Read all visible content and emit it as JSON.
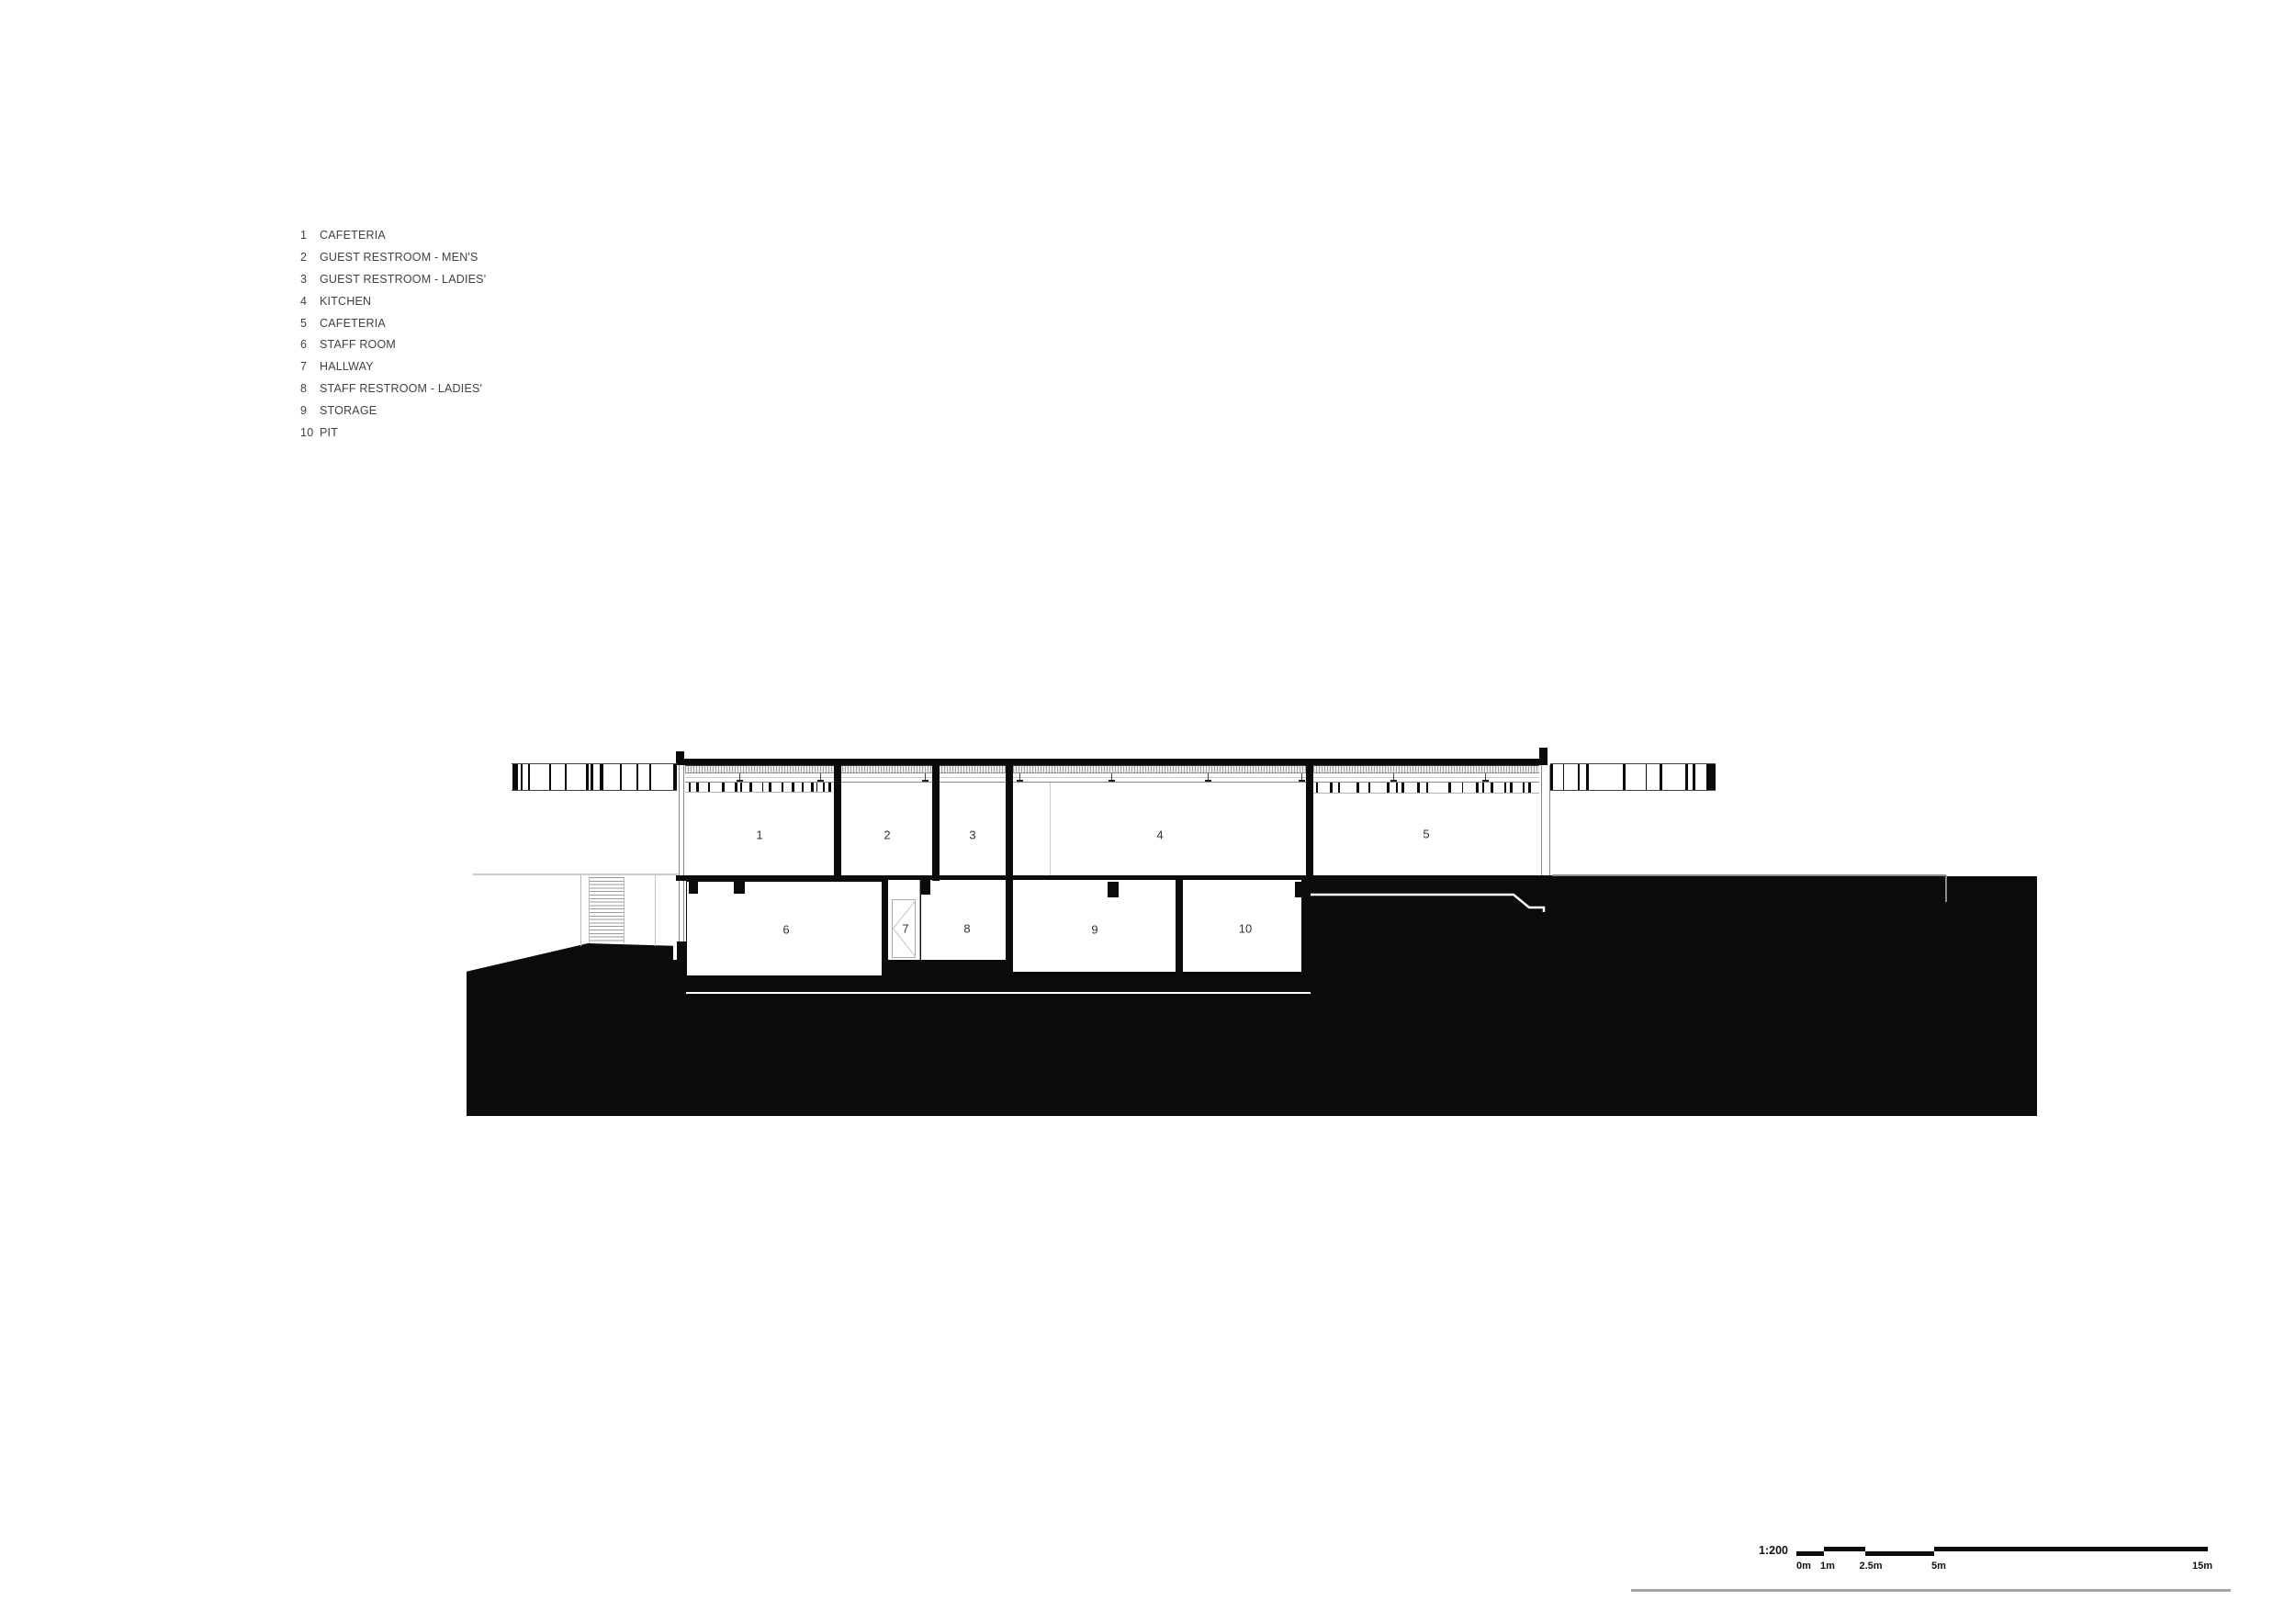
{
  "legend": {
    "items": [
      {
        "num": "1",
        "label": "CAFETERIA"
      },
      {
        "num": "2",
        "label": "GUEST RESTROOM - MEN'S"
      },
      {
        "num": "3",
        "label": "GUEST RESTROOM - LADIES'"
      },
      {
        "num": "4",
        "label": "KITCHEN"
      },
      {
        "num": "5",
        "label": "CAFETERIA"
      },
      {
        "num": "6",
        "label": "STAFF ROOM"
      },
      {
        "num": "7",
        "label": "HALLWAY"
      },
      {
        "num": "8",
        "label": "STAFF RESTROOM - LADIES'"
      },
      {
        "num": "9",
        "label": "STORAGE"
      },
      {
        "num": "10",
        "label": "PIT"
      }
    ]
  },
  "rooms": [
    {
      "number": "1"
    },
    {
      "number": "2"
    },
    {
      "number": "3"
    },
    {
      "number": "4"
    },
    {
      "number": "5"
    },
    {
      "number": "6"
    },
    {
      "number": "7"
    },
    {
      "number": "8"
    },
    {
      "number": "9"
    },
    {
      "number": "10"
    }
  ],
  "scale_bar": {
    "ratio": "1:200",
    "tick_labels": [
      "0m",
      "1m",
      "2.5m",
      "5m",
      "15m"
    ]
  },
  "colors": {
    "ink": "#0b0b0b",
    "detail_gray": "#8a8a8a",
    "text_gray": "#414141"
  }
}
